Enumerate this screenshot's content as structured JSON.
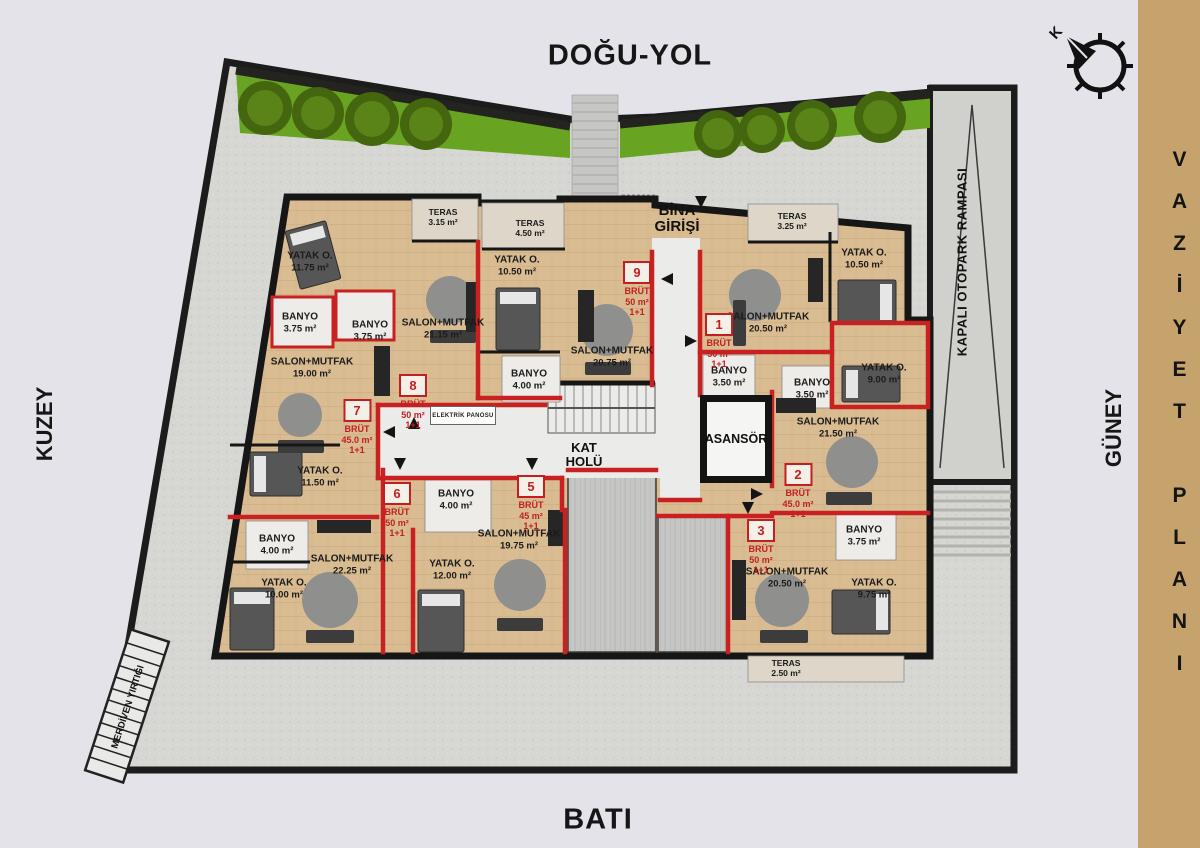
{
  "title": {
    "plan_label": "VAZİYET PLANI"
  },
  "directions": {
    "east_road": "DOĞU-YOL",
    "north": "KUZEY",
    "south": "GÜNEY",
    "west": "BATI",
    "compass_letter": "K"
  },
  "site": {
    "entrance_label": "BİNA GİRİŞİ",
    "hall_label": "KAT HOLÜ",
    "elevator_label": "ASANSÖR",
    "electric_panel_label": "ELEKTRİK PANOSU",
    "parking_ramp_label": "KAPALI OTOPARK RAMPASI",
    "stair_gap_label": "MERDİVEN YIRTIĞI"
  },
  "colors": {
    "accent_band": "#c6a36c",
    "red_wall": "#c92121",
    "grass": "#69a322",
    "wood_floor": "#d9bc92"
  },
  "units": [
    {
      "no": "1",
      "gross_label": "BRÜT",
      "area": "50 m²",
      "type": "1+1",
      "x": 719,
      "y": 313
    },
    {
      "no": "2",
      "gross_label": "BRÜT",
      "area": "45.0 m²",
      "type": "1+1",
      "x": 798,
      "y": 463
    },
    {
      "no": "3",
      "gross_label": "BRÜT",
      "area": "50 m²",
      "type": "1+1",
      "x": 761,
      "y": 519
    },
    {
      "no": "5",
      "gross_label": "BRÜT",
      "area": "45 m²",
      "type": "1+1",
      "x": 531,
      "y": 475
    },
    {
      "no": "6",
      "gross_label": "BRÜT",
      "area": "50 m²",
      "type": "1+1",
      "x": 397,
      "y": 482
    },
    {
      "no": "7",
      "gross_label": "BRÜT",
      "area": "45.0 m²",
      "type": "1+1",
      "x": 357,
      "y": 399
    },
    {
      "no": "8",
      "gross_label": "BRÜT",
      "area": "50 m²",
      "type": "1+1",
      "x": 413,
      "y": 374
    },
    {
      "no": "9",
      "gross_label": "BRÜT",
      "area": "50 m²",
      "type": "1+1",
      "x": 637,
      "y": 261
    }
  ],
  "rooms": [
    {
      "name": "YATAK O.",
      "area": "11.75 m²",
      "x": 310,
      "y": 262
    },
    {
      "name": "TERAS",
      "area": "3.15 m²",
      "x": 443,
      "y": 217,
      "small": true
    },
    {
      "name": "TERAS",
      "area": "4.50 m²",
      "x": 530,
      "y": 228,
      "small": true
    },
    {
      "name": "YATAK O.",
      "area": "10.50 m²",
      "x": 517,
      "y": 266
    },
    {
      "name": "TERAS",
      "area": "3.25 m²",
      "x": 792,
      "y": 221,
      "small": true
    },
    {
      "name": "YATAK O.",
      "area": "10.50 m²",
      "x": 864,
      "y": 259
    },
    {
      "name": "BANYO",
      "area": "3.75 m²",
      "x": 300,
      "y": 323
    },
    {
      "name": "BANYO",
      "area": "3.75 m²",
      "x": 370,
      "y": 331
    },
    {
      "name": "SALON+MUTFAK",
      "area": "21.15 m²",
      "x": 443,
      "y": 329
    },
    {
      "name": "SALON+MUTFAK",
      "area": "20.75 m²",
      "x": 612,
      "y": 357
    },
    {
      "name": "SALON+MUTFAK",
      "area": "20.50 m²",
      "x": 768,
      "y": 323
    },
    {
      "name": "BANYO",
      "area": "4.00 m²",
      "x": 529,
      "y": 380
    },
    {
      "name": "BANYO",
      "area": "3.50 m²",
      "x": 729,
      "y": 377
    },
    {
      "name": "BANYO",
      "area": "3.50 m²",
      "x": 812,
      "y": 389
    },
    {
      "name": "YATAK O.",
      "area": "9.00 m²",
      "x": 884,
      "y": 374
    },
    {
      "name": "SALON+MUTFAK",
      "area": "19.00 m²",
      "x": 312,
      "y": 368
    },
    {
      "name": "YATAK O.",
      "area": "11.50 m²",
      "x": 320,
      "y": 477
    },
    {
      "name": "SALON+MUTFAK",
      "area": "21.50 m²",
      "x": 838,
      "y": 428
    },
    {
      "name": "BANYO",
      "area": "4.00 m²",
      "x": 456,
      "y": 500
    },
    {
      "name": "BANYO",
      "area": "4.00 m²",
      "x": 277,
      "y": 545
    },
    {
      "name": "YATAK O.",
      "area": "10.00 m²",
      "x": 284,
      "y": 589
    },
    {
      "name": "SALON+MUTFAK",
      "area": "22.25 m²",
      "x": 352,
      "y": 565
    },
    {
      "name": "YATAK O.",
      "area": "12.00 m²",
      "x": 452,
      "y": 570
    },
    {
      "name": "SALON+MUTFAK",
      "area": "19.75 m²",
      "x": 519,
      "y": 540
    },
    {
      "name": "BANYO",
      "area": "3.75 m²",
      "x": 864,
      "y": 536
    },
    {
      "name": "SALON+MUTFAK",
      "area": "20.50 m²",
      "x": 787,
      "y": 578
    },
    {
      "name": "YATAK O.",
      "area": "9.75 m²",
      "x": 874,
      "y": 589
    },
    {
      "name": "TERAS",
      "area": "2.50 m²",
      "x": 786,
      "y": 668,
      "small": true
    }
  ]
}
